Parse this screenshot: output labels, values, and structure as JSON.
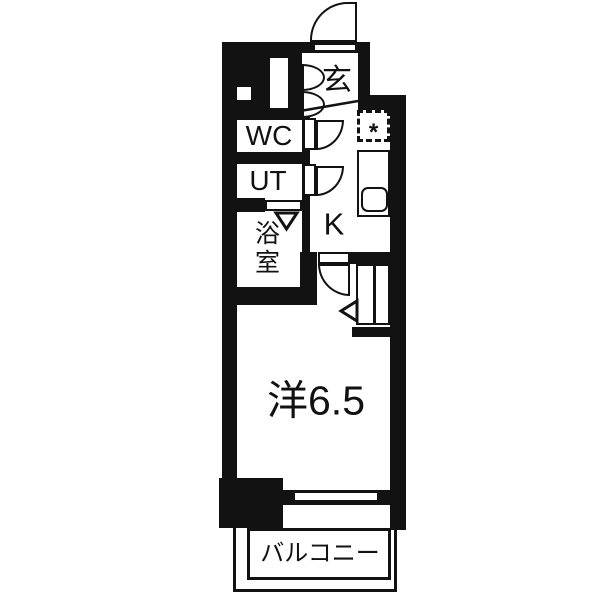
{
  "plan": {
    "type": "apartment-floor-plan",
    "background_color": "#ffffff",
    "wall_color": "#121212",
    "rooms": {
      "entrance": {
        "label": "玄"
      },
      "wc": {
        "label": "WC"
      },
      "utility": {
        "label": "UT"
      },
      "bathroom": {
        "label": "浴室"
      },
      "kitchen": {
        "label": "K"
      },
      "main_room": {
        "label": "洋6.5"
      },
      "balcony": {
        "label": "バルコニー"
      }
    },
    "fixtures": {
      "washer_pan_mark": "*"
    }
  }
}
